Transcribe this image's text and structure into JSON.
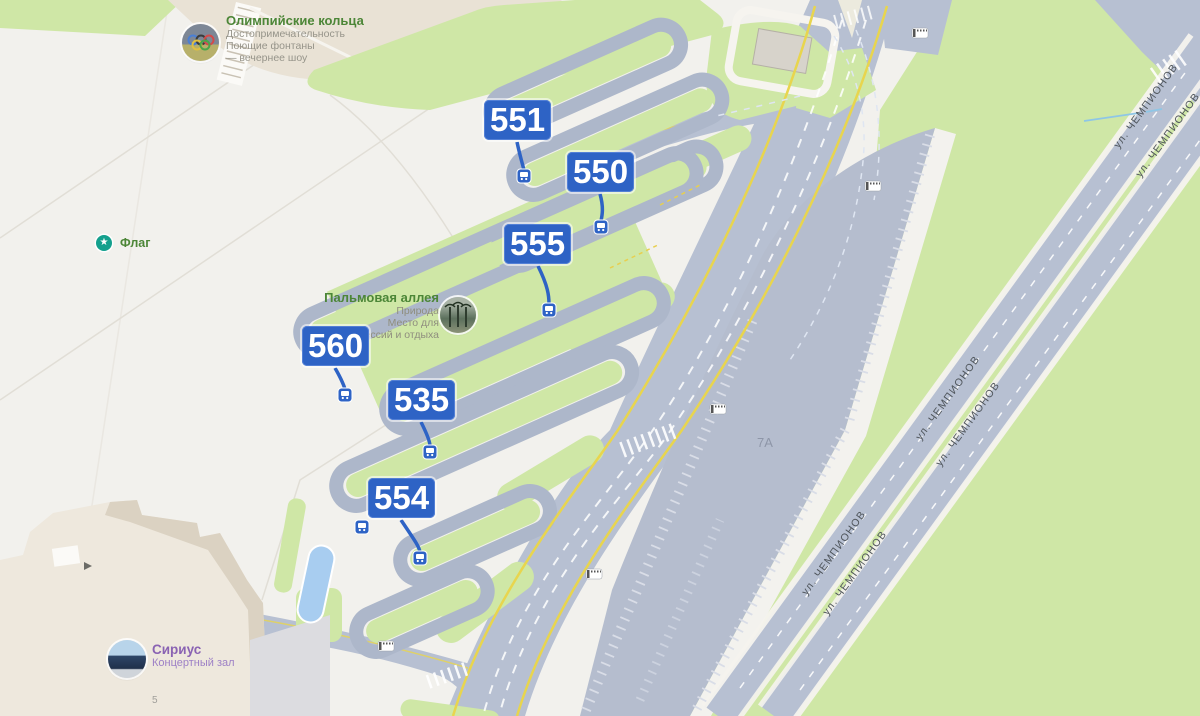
{
  "street": {
    "name": "ул. ЧЕМПИОНОВ"
  },
  "markers": {
    "items": [
      {
        "label": "551"
      },
      {
        "label": "550"
      },
      {
        "label": "555"
      },
      {
        "label": "560"
      },
      {
        "label": "535"
      },
      {
        "label": "554"
      }
    ]
  },
  "pois": {
    "olympic_rings": {
      "title": "Олимпийские кольца",
      "category": "Достопримечательность",
      "line2": "Поющие фонтаны",
      "line3": "— вечернее шоу"
    },
    "flag": {
      "title": "Флаг"
    },
    "palm_alley": {
      "title": "Пальмовая аллея",
      "category": "Природа",
      "line2": "Место для",
      "line3": "осессий и отдыха"
    },
    "sirius": {
      "title": "Сириус",
      "subtitle": "Концертный зал"
    }
  },
  "area_labels": {
    "parking_lot": "7А",
    "building_number": "5"
  },
  "colors": {
    "marker_blue": "#2e63c5",
    "road_gray": "#b7c0d2",
    "lot_gray": "#b5bdce",
    "green": "#cfe7a6",
    "beige": "#e9e2d5",
    "yellow_line": "#e8d54e",
    "poi_green": "#4c8637",
    "poi_purple": "#8a63b3",
    "street_text": "#4e545a",
    "water_blue": "#8ec6e6"
  }
}
